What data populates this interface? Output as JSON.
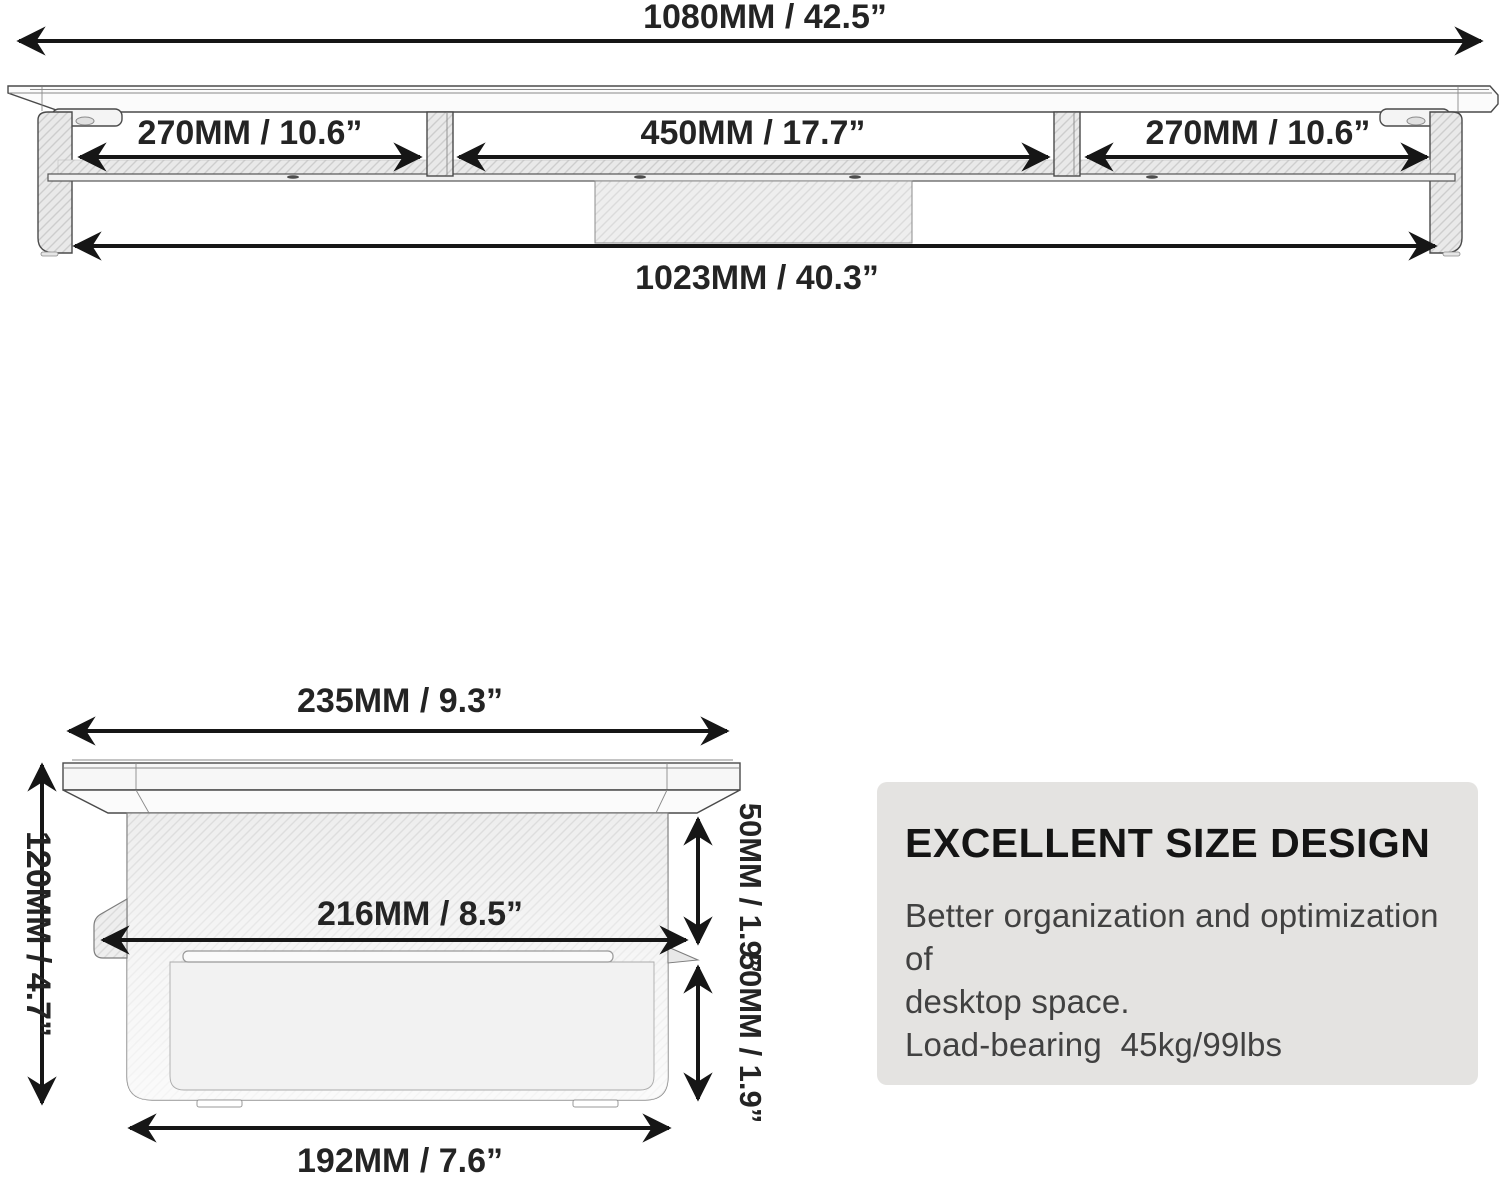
{
  "front_view": {
    "total_width": "1080MM / 42.5”",
    "left_section": "270MM / 10.6”",
    "middle_section": "450MM / 17.7”",
    "right_section": "270MM / 10.6”",
    "inner_width": "1023MM / 40.3”"
  },
  "side_view": {
    "top_depth": "235MM / 9.3”",
    "height": "120MM / 4.7”",
    "inner_depth": "216MM / 8.5”",
    "upper_clearance": "50MM / 1.9”",
    "lower_clearance": "50MM / 1.9”",
    "base_depth": "192MM / 7.6”"
  },
  "info_panel": {
    "title": "EXCELLENT SIZE DESIGN",
    "line1": "Better organization and optimization of",
    "line2": "desktop space.",
    "line3": "Load-bearing  45kg/99lbs"
  },
  "colors": {
    "background": "#ffffff",
    "line": "#161616",
    "hatch_fill": "#e9e9e9",
    "hatch_line": "#cdcdcd",
    "panel_background": "#e4e3e1",
    "text": "#242424"
  }
}
